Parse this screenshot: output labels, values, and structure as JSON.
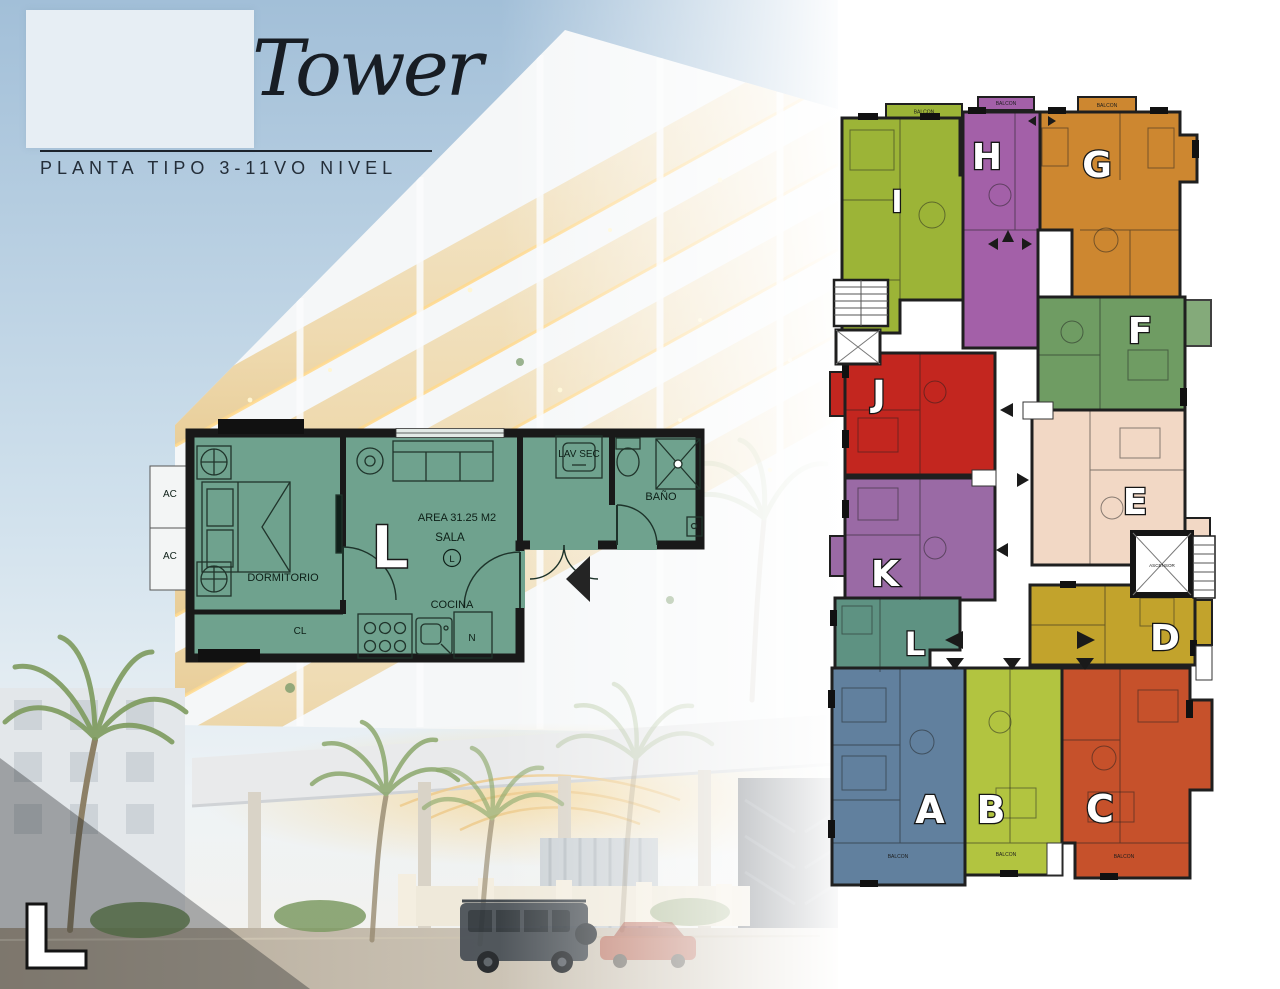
{
  "header": {
    "title": "Tower",
    "subtitle": "PLANTA TIPO 3-11VO NIVEL"
  },
  "unit_plan": {
    "big_letter": "L",
    "area_label": "AREA 31.25 M2",
    "sala": "SALA",
    "sala_circle_letter": "L",
    "cocina": "COCINA",
    "dormitorio": "DORMITORIO",
    "closet": "CL",
    "laundry": "LAV SEC",
    "bathroom": "BAÑO",
    "fridge": "N",
    "ac_top": "AC",
    "ac_bottom": "AC",
    "floor_color": "#6fa28e",
    "wall_color": "#191919"
  },
  "floor_plate": {
    "elevator_label": "ASCENSOR",
    "balcony_label": "BALCON",
    "units": {
      "A": {
        "label": "A",
        "color": "#61809e"
      },
      "B": {
        "label": "B",
        "color": "#b2c440"
      },
      "C": {
        "label": "C",
        "color": "#c6512b"
      },
      "D": {
        "label": "D",
        "color": "#c2a32c"
      },
      "E": {
        "label": "E",
        "color": "#f2d8c5"
      },
      "F": {
        "label": "F",
        "color": "#6f9c63"
      },
      "G": {
        "label": "G",
        "color": "#cd8730"
      },
      "H": {
        "label": "H",
        "color": "#a360a8"
      },
      "I": {
        "label": "I",
        "color": "#9cb437"
      },
      "J": {
        "label": "J",
        "color": "#c3261f"
      },
      "K": {
        "label": "K",
        "color": "#9a6aa5"
      },
      "L": {
        "label": "L",
        "color": "#5e9282"
      }
    }
  },
  "corner_letter": "L",
  "palette": {
    "sky_top": "#a2bfd8",
    "sky_mid": "#cfe0ec",
    "balcony_glow": "#f0dcb0",
    "wall_black": "#1f1f1f"
  }
}
